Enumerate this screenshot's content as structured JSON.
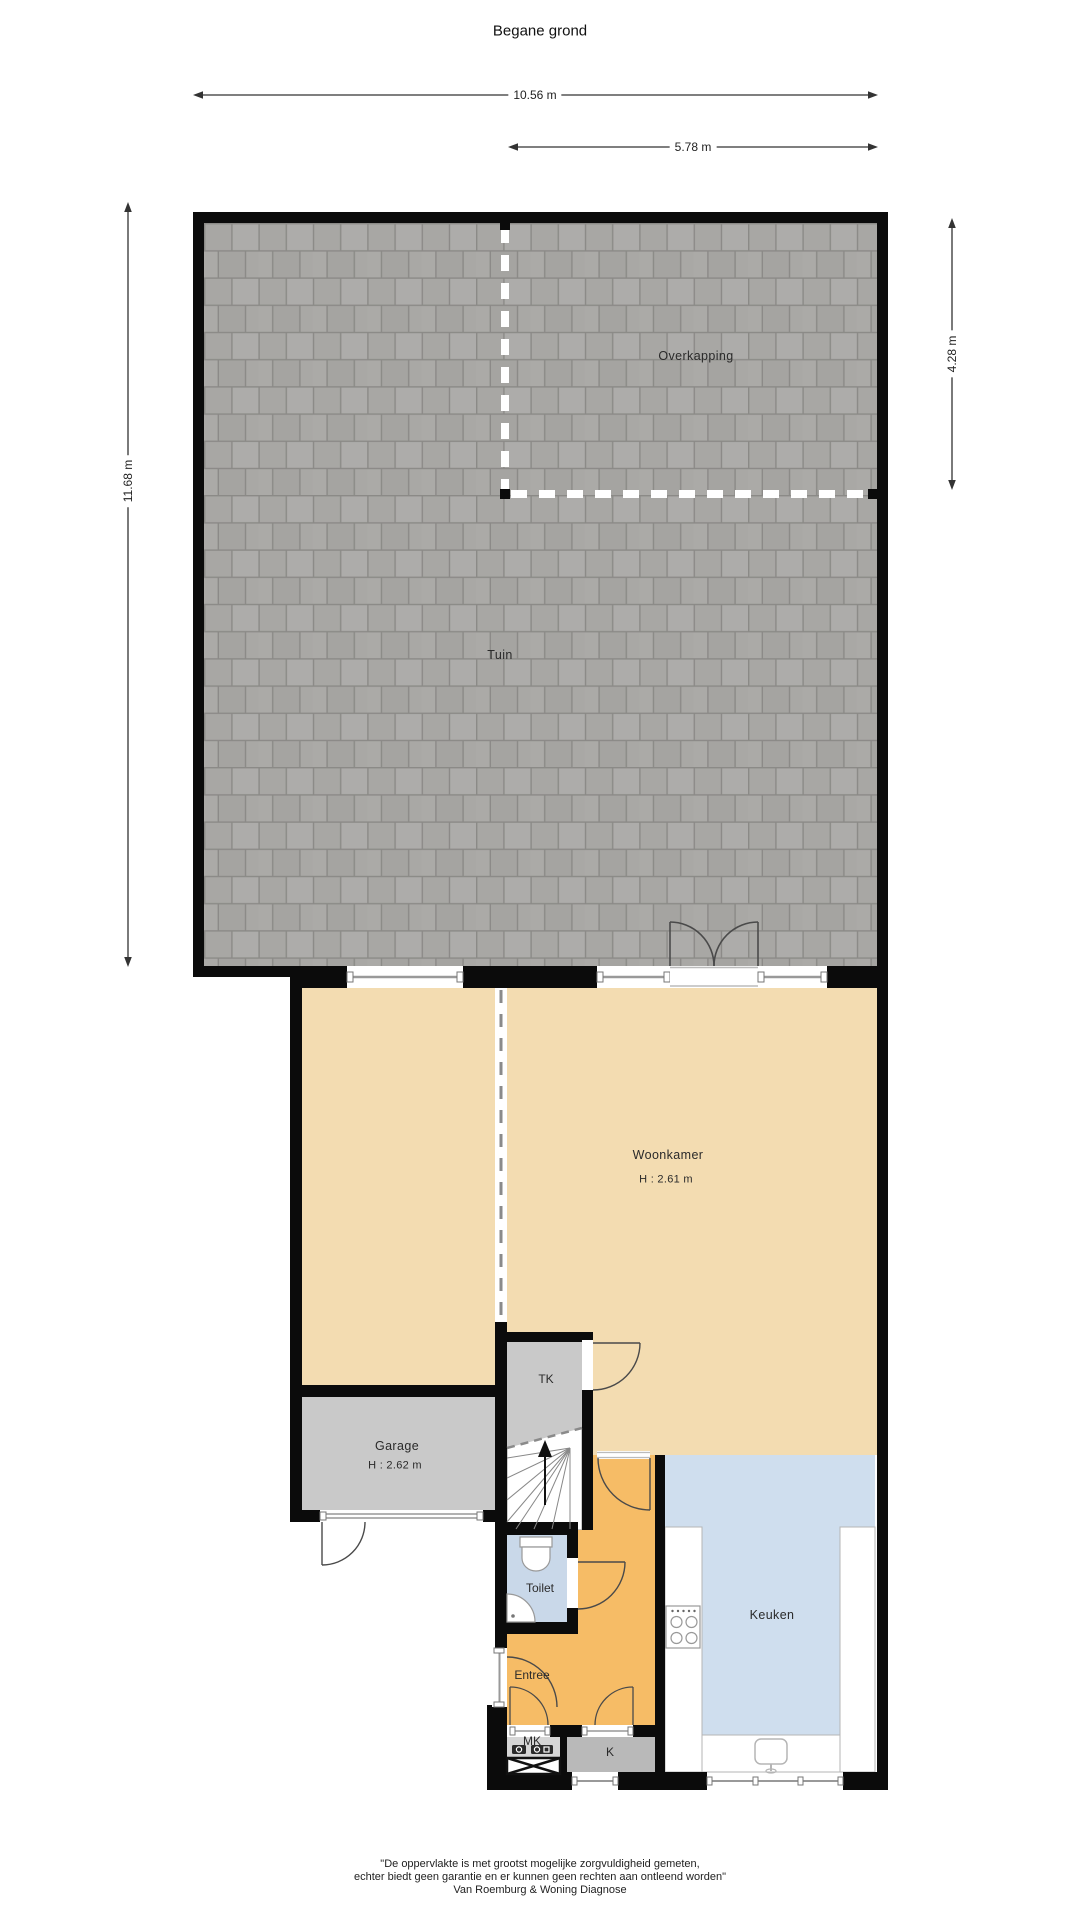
{
  "plan": {
    "title": "Begane grond"
  },
  "dimensions": {
    "total_width": "10.56 m",
    "overkapping_width": "5.78 m",
    "garden_height": "11.68 m",
    "overkapping_height": "4.28 m"
  },
  "rooms": {
    "tuin": "Tuin",
    "overkapping": "Overkapping",
    "woonkamer": "Woonkamer",
    "woonkamer_height": "H : 2.61 m",
    "garage": "Garage",
    "garage_height": "H : 2.62 m",
    "tk": "TK",
    "toilet": "Toilet",
    "entree": "Entree",
    "mk": "MK",
    "k": "K",
    "keuken": "Keuken"
  },
  "footer": {
    "line1": "\"De oppervlakte is met grootst mogelijke zorgvuldigheid gemeten,",
    "line2": "echter biedt geen garantie en er kunnen geen rechten aan ontleend worden\"",
    "line3": "Van Roemburg & Woning Diagnose"
  },
  "colors": {
    "wall": "#0b0b0b",
    "living_beige": "#f3dcb1",
    "hall_orange": "#f6bc66",
    "kitchen_blue": "#cfdeee",
    "toilet_blue": "#c9d8e9",
    "garage_gray": "#c9c9c9",
    "closet_gray": "#b9b9b9",
    "tile_gray": "#a8a7a4",
    "frame_gray": "#999999"
  }
}
